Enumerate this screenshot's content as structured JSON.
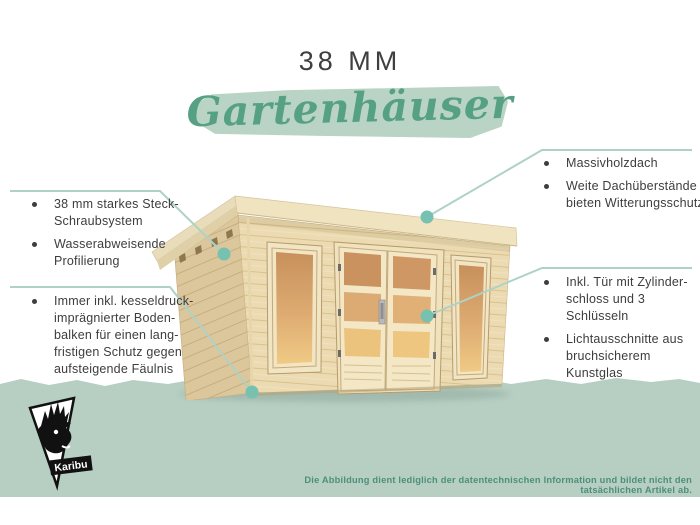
{
  "header": {
    "size_label": "38 MM",
    "category_script": "Gartenhäuser"
  },
  "callouts": {
    "left_top": {
      "items": [
        "38 mm starkes Steck-\nSchraubsystem",
        "Wasserabweisende\nProfilierung"
      ]
    },
    "left_bottom": {
      "items": [
        "Immer inkl. kesseldruck-\nimprägnierter Boden-\nbalken für einen lang-\nfristigen Schutz gegen\naufsteigende Fäulnis"
      ]
    },
    "right_top": {
      "items": [
        "Massivholzdach",
        "Weite Dachüberstände\nbieten Witterungsschutz"
      ]
    },
    "right_bottom": {
      "items": [
        "Inkl. Tür mit Zylinder-\nschloss und 3 Schlüsseln",
        "Lichtausschnitte aus\nbruchsicherem Kunstglas"
      ]
    }
  },
  "footer": {
    "disclaimer": "Die Abbildung dient lediglich der datentechnischen Information und bildet nicht den tatsächlichen Artikel ab.",
    "logo_label": "Karibu"
  },
  "colors": {
    "accent_green": "#56a083",
    "brush_green": "#b9d4c4",
    "ground_band": "#b6cfc2",
    "callout_line": "#aed2c5",
    "callout_dot": "#76c1af",
    "text_dark": "#3d3d3d",
    "disclaimer_green": "#4e8e7b"
  }
}
